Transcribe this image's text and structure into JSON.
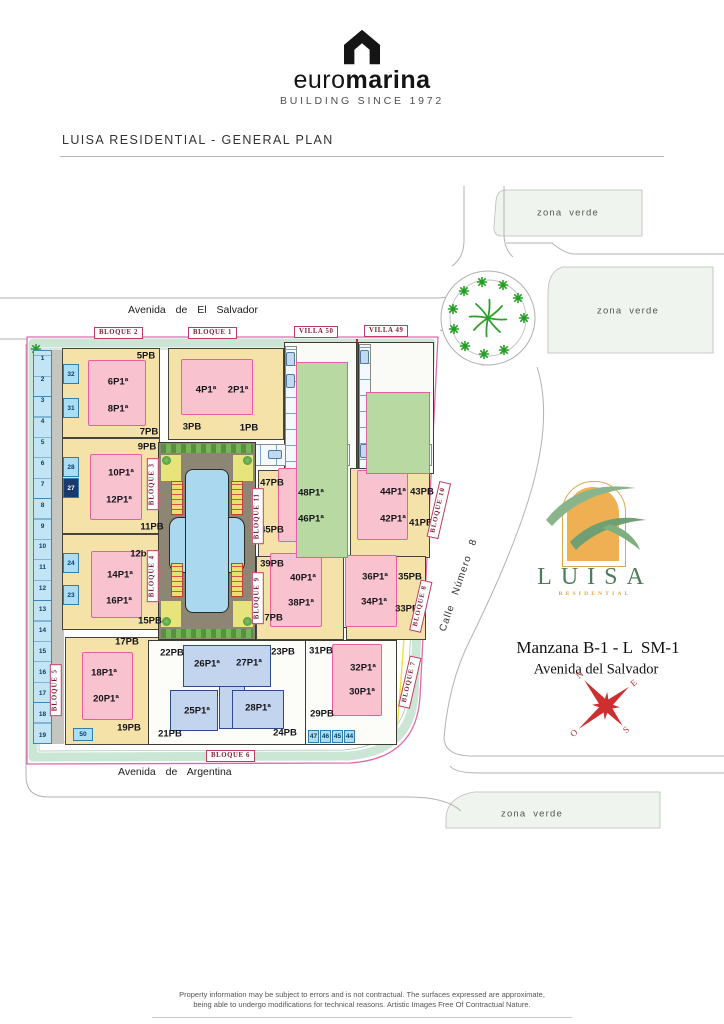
{
  "header": {
    "brand_first": "euro",
    "brand_second": "marina",
    "tagline": "BUILDING SINCE 1972"
  },
  "title": "LUISA RESIDENTIAL - GENERAL PLAN",
  "map": {
    "streets": {
      "el_salvador": "Avenida de El Salvador",
      "argentina": "Avenida de Argentina",
      "calle": "Calle Número 8"
    },
    "zona_verde": "zona verde",
    "villas": {
      "v50": "VILLA 50",
      "v49": "VILLA 49"
    },
    "bloques": {
      "b1": "BLOQUE 1",
      "b2": "BLOQUE 2",
      "b3": "BLOQUE 3",
      "b4": "BLOQUE 4",
      "b5": "BLOQUE 5",
      "b6": "BLOQUE 6",
      "b7": "BLOQUE 7",
      "b8": "BLOQUE 8",
      "b9": "BLOQUE 9",
      "b10": "BLOQUE 10",
      "b11": "BLOQUE 11"
    },
    "units": {
      "b2": [
        "5PB",
        "6P1ª",
        "8P1ª",
        "7PB"
      ],
      "b3": [
        "9PB",
        "10P1ª",
        "12P1ª",
        "11PB"
      ],
      "b4": [
        "12bPB",
        "14P1ª",
        "16P1ª",
        "15PB"
      ],
      "b5": [
        "17PB",
        "18P1ª",
        "20P1ª",
        "19PB"
      ],
      "b1": [
        "4P1ª",
        "2P1ª",
        "3PB",
        "1PB"
      ],
      "b11": [
        "47PB",
        "48P1ª",
        "46P1ª",
        "45PB"
      ],
      "b10": [
        "44P1ª",
        "42P1ª",
        "43PB",
        "41PB"
      ],
      "b9": [
        "39PB",
        "40P1ª",
        "38P1ª",
        "37PB"
      ],
      "b8": [
        "36P1ª",
        "34P1ª",
        "35PB",
        "33PB"
      ],
      "b6": [
        "22PB",
        "23PB",
        "26P1ª",
        "27P1ª",
        "25P1ª",
        "28P1ª",
        "21PB",
        "24PB"
      ],
      "b7": [
        "31PB",
        "32P1ª",
        "30P1ª",
        "29PB"
      ]
    },
    "parking": {
      "left_strip": [
        "1",
        "2",
        "3",
        "4",
        "5",
        "6",
        "7",
        "8",
        "9",
        "10",
        "11",
        "12",
        "13",
        "14",
        "15",
        "16",
        "17",
        "18",
        "19"
      ],
      "inner": [
        "32",
        "31",
        "28",
        "27",
        "24",
        "23"
      ],
      "slot50": "50",
      "row_bottom": [
        "47",
        "46",
        "45",
        "44"
      ]
    }
  },
  "branding": {
    "logo_title": "LUISA",
    "logo_subtitle": "RESIDENTIAL",
    "manzana": "Manzana B-1 - L  SM-1",
    "street": "Avenida del Salvador"
  },
  "compass": {
    "n": "N",
    "e": "E",
    "s": "S",
    "o": "O"
  },
  "footer": {
    "line1": "Property information may be subject to errors and is not contractual. The surfaces expressed are approximate,",
    "line2": "being able to undergo modifications for technical reasons. Artistic Images Free Of Contractual Nature."
  }
}
